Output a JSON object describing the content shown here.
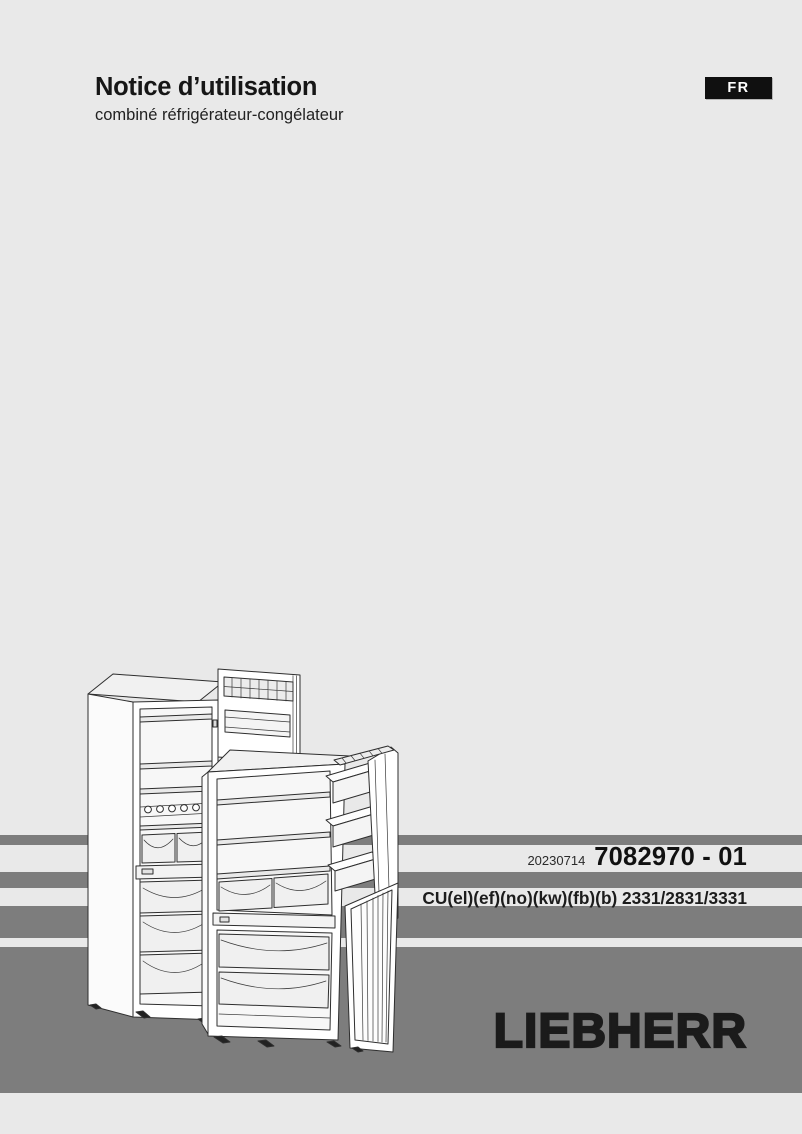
{
  "colors": {
    "page_background": "#e9e9e9",
    "stripe_gray": "#7d7d7d",
    "badge_background": "#101010",
    "badge_text": "#ffffff",
    "heading_text": "#1a1a1a",
    "logo_black": "#1b1b1b"
  },
  "header": {
    "title": "Notice d’utilisation",
    "subtitle": "combiné réfrigérateur-congélateur",
    "language_badge": "FR"
  },
  "publication": {
    "date_code": "20230714",
    "document_number": "7082970 - 01"
  },
  "models": {
    "codes": "CU(el)(ef)(no)(kw)(fb)(b) 2331/2831/3331"
  },
  "brand": {
    "logo": "LIEBHERR"
  },
  "illustration": {
    "name": "combined-fridge-freezer-line-drawing"
  }
}
